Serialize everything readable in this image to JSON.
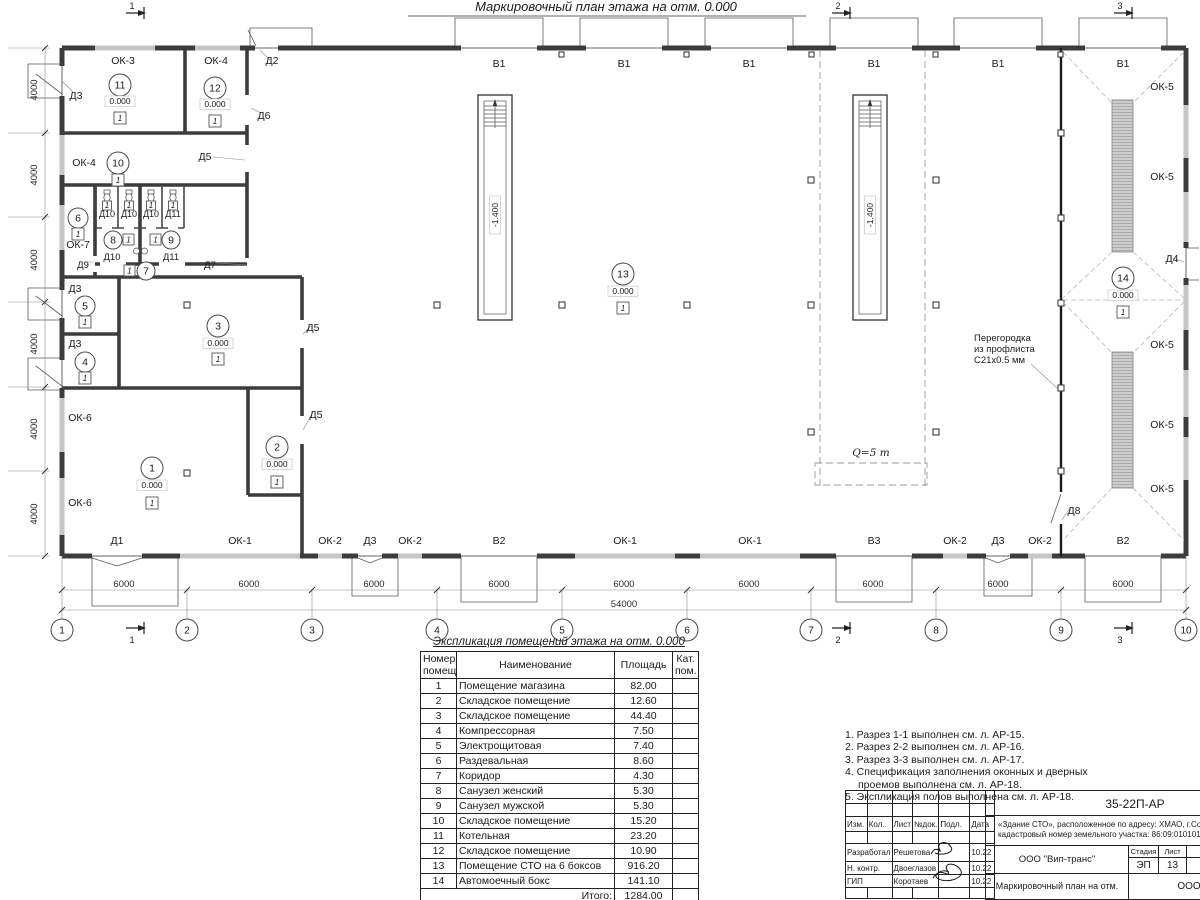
{
  "plan": {
    "title": "Маркировочный план этажа на отм. 0.000",
    "elev_zero": "0.000",
    "pit_elev": "-1.400",
    "floor_marker": "1",
    "crane_load": "Q=5 т",
    "partition_note": [
      "Перегородка",
      "из профлиста",
      "С21х0.5 мм"
    ],
    "room_numbers": [
      "1",
      "2",
      "3",
      "4",
      "5",
      "6",
      "7",
      "8",
      "9",
      "10",
      "11",
      "12",
      "13",
      "14"
    ],
    "grid_bubbles": [
      "1",
      "2",
      "3",
      "4",
      "5",
      "6",
      "7",
      "8",
      "9",
      "10"
    ],
    "sections": [
      "1",
      "2",
      "3"
    ],
    "dims": {
      "bay": "6000",
      "total": "54000",
      "row": "4000"
    },
    "openings": {
      "top_gates": [
        "В1",
        "В1",
        "В1",
        "В1",
        "В1",
        "В1"
      ],
      "bottom": [
        "Д1",
        "ОК-1",
        "ОК-2",
        "Д3",
        "ОК-2",
        "В2",
        "ОК-1",
        "ОК-1",
        "В3",
        "ОК-2",
        "Д3",
        "ОК-2",
        "В2"
      ],
      "ok5": [
        "ОК-5",
        "ОК-5",
        "ОК-5",
        "ОК-5",
        "ОК-5"
      ],
      "ok3": "ОК-3",
      "ok4a": "ОК-4",
      "ok4b": "ОК-4",
      "ok6a": "ОК-6",
      "ok6b": "ОК-6",
      "ok7": "ОК-7",
      "d2": "Д2",
      "d3a": "Д3",
      "d3b": "Д3",
      "d3c": "Д3",
      "d4": "Д4",
      "d5a": "Д5",
      "d5b": "Д5",
      "d5c": "Д5",
      "d6": "Д6",
      "d7": "Д7",
      "d8": "Д8",
      "d9": "Д9",
      "stall_doors": [
        "Д10",
        "Д10",
        "Д10",
        "Д11"
      ],
      "d10b": "Д10",
      "d11b": "Д11"
    }
  },
  "schedule": {
    "title": "Экспликация помещений этажа на отм. 0.000",
    "headers": [
      "Номер помещ.",
      "Наименование",
      "Площадь",
      "Кат. пом."
    ],
    "rows": [
      [
        "1",
        "Помещение магазина",
        "82.00",
        ""
      ],
      [
        "2",
        "Складское помещение",
        "12.60",
        ""
      ],
      [
        "3",
        "Складское помещение",
        "44.40",
        ""
      ],
      [
        "4",
        "Компрессорная",
        "7.50",
        ""
      ],
      [
        "5",
        "Электрощитовая",
        "7.40",
        ""
      ],
      [
        "6",
        "Раздевальная",
        "8.60",
        ""
      ],
      [
        "7",
        "Коридор",
        "4.30",
        ""
      ],
      [
        "8",
        "Санузел женский",
        "5.30",
        ""
      ],
      [
        "9",
        "Санузел мужской",
        "5.30",
        ""
      ],
      [
        "10",
        "Складское помещение",
        "15.20",
        ""
      ],
      [
        "11",
        "Котельная",
        "23.20",
        ""
      ],
      [
        "12",
        "Складское помещение",
        "10.90",
        ""
      ],
      [
        "13",
        "Помещение СТО на 6 боксов",
        "916.20",
        ""
      ],
      [
        "14",
        "Автомоечный бокс",
        "141.10",
        ""
      ]
    ],
    "total_label": "Итого:",
    "total_value": "1284.00"
  },
  "notes": [
    "1. Разрез 1-1 выполнен см. л. АР-15.",
    "2. Разрез 2-2 выполнен см. л. АР-16.",
    "3. Разрез 3-3 выполнен см. л. АР-17.",
    "4. Спецификация заполнения оконных и дверных",
    "проемов выполнена см. л. АР-18.",
    "5. Экспликация полов выполнена см. л. АР-18."
  ],
  "titleblock": {
    "doc_number": "35-22П-АР",
    "object_line1": "«Здание СТО», расположенное по адресу: ХМАО, г.Советский,",
    "object_line2": "кадастровый номер земельного участка: 86:09:0101016:1",
    "sig_headers": [
      "Изм.",
      "Кол.",
      "Лист",
      "№док.",
      "Подл.",
      "Дата"
    ],
    "sig_rows": [
      [
        "Разработал",
        "Решетова",
        "10.22"
      ],
      [
        "Н. контр.",
        "Двоеглазов",
        "10.22"
      ],
      [
        "ГИП",
        "Коротаев",
        "10.22"
      ]
    ],
    "org": "ООО \"Вип-транс\"",
    "stage_label": "Стадия",
    "sheet_label": "Лист",
    "sheets_label": "Л",
    "stage": "ЭП",
    "sheet": "13",
    "drawing_title": "Маркировочный план на отм. 0.000",
    "org2": "ООО \"Альян"
  }
}
